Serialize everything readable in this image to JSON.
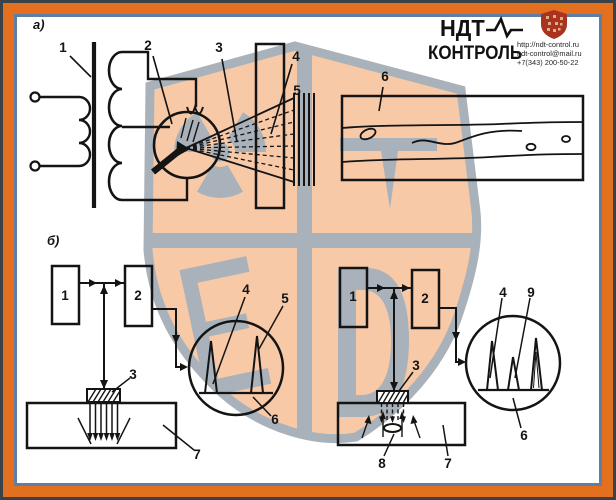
{
  "logo": {
    "title_top": "НДТ",
    "title_bottom": "КОНТРОЛЬ",
    "website": "http://ndt-control.ru",
    "email": "ndt-control@mail.ru",
    "phone": "+7(343) 200-50-22"
  },
  "colors": {
    "frame_orange": "#e2701f",
    "frame_slate": "#5e7ea6",
    "frame_dark": "#3b4149",
    "ink": "#141414",
    "watermark_peach": "#f8c9a7",
    "watermark_gray": "#a9b2ba",
    "logo_shield_red": "#a93220"
  },
  "panel_a": {
    "label": "а)",
    "callouts": {
      "c1": "1",
      "c2": "2",
      "c3": "3",
      "c4": "4",
      "c5": "5",
      "c6": "6"
    }
  },
  "panel_b_left": {
    "label": "б)",
    "callouts": {
      "c1": "1",
      "c2": "2",
      "c3": "3",
      "c4": "4",
      "c5": "5",
      "c6": "6",
      "c7": "7"
    }
  },
  "panel_b_right": {
    "callouts": {
      "c1": "1",
      "c2": "2",
      "c3": "3",
      "c4": "4",
      "c9": "9",
      "c6": "6",
      "c7": "7",
      "c8": "8"
    }
  }
}
